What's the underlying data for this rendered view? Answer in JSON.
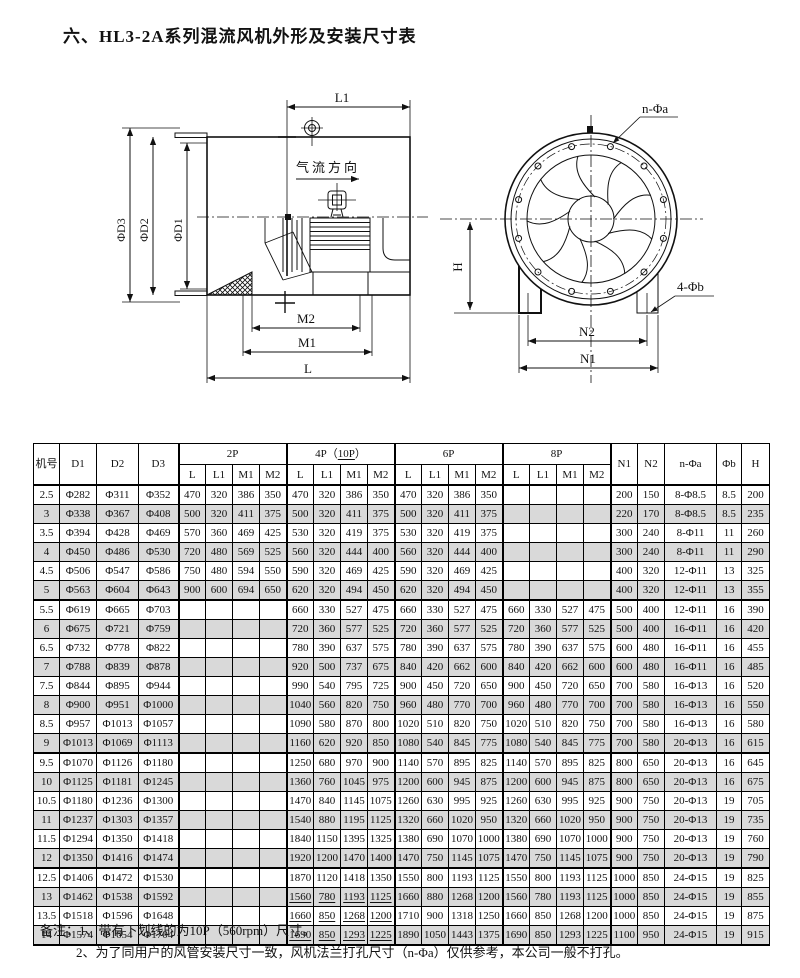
{
  "title": "六、HL3-2A系列混流风机外形及安装尺寸表",
  "diagrams": {
    "left": {
      "l1": "L1",
      "d3": "ΦD3",
      "d2": "ΦD2",
      "d1": "ΦD1",
      "airflow": "气流方向",
      "m2": "M2",
      "m1": "M1",
      "l": "L"
    },
    "right": {
      "n_phi_a": "n-Φa",
      "h": "H",
      "four_phi_b": "4-Φb",
      "n2": "N2",
      "n1": "N1"
    }
  },
  "table": {
    "header": {
      "jihao": "机号",
      "d1": "D1",
      "d2": "D2",
      "d3": "D3",
      "g2": "2P",
      "g4_pre": "4P（",
      "g4_u": "10P",
      "g4_post": "）",
      "g6": "6P",
      "g8": "8P",
      "sub": [
        "L",
        "L1",
        "M1",
        "M2"
      ],
      "n1": "N1",
      "n2": "N2",
      "na": "n-Φa",
      "b": "Φb",
      "h": "H"
    },
    "rows": [
      {
        "no": "2.5",
        "d1": "Φ282",
        "d2": "Φ311",
        "d3": "Φ352",
        "p2": [
          "470",
          "320",
          "386",
          "350"
        ],
        "p4": [
          "470",
          "320",
          "386",
          "350"
        ],
        "p6": [
          "470",
          "320",
          "386",
          "350"
        ],
        "p8": [
          "",
          "",
          "",
          ""
        ],
        "n1": "200",
        "n2": "150",
        "na": "8-Φ8.5",
        "b": "8.5",
        "h": "200",
        "u": false
      },
      {
        "no": "3",
        "d1": "Φ338",
        "d2": "Φ367",
        "d3": "Φ408",
        "p2": [
          "500",
          "320",
          "411",
          "375"
        ],
        "p4": [
          "500",
          "320",
          "411",
          "375"
        ],
        "p6": [
          "500",
          "320",
          "411",
          "375"
        ],
        "p8": [
          "",
          "",
          "",
          ""
        ],
        "n1": "220",
        "n2": "170",
        "na": "8-Φ8.5",
        "b": "8.5",
        "h": "235",
        "u": false
      },
      {
        "no": "3.5",
        "d1": "Φ394",
        "d2": "Φ428",
        "d3": "Φ469",
        "p2": [
          "570",
          "360",
          "469",
          "425"
        ],
        "p4": [
          "530",
          "320",
          "419",
          "375"
        ],
        "p6": [
          "530",
          "320",
          "419",
          "375"
        ],
        "p8": [
          "",
          "",
          "",
          ""
        ],
        "n1": "300",
        "n2": "240",
        "na": "8-Φ11",
        "b": "11",
        "h": "260",
        "u": false
      },
      {
        "no": "4",
        "d1": "Φ450",
        "d2": "Φ486",
        "d3": "Φ530",
        "p2": [
          "720",
          "480",
          "569",
          "525"
        ],
        "p4": [
          "560",
          "320",
          "444",
          "400"
        ],
        "p6": [
          "560",
          "320",
          "444",
          "400"
        ],
        "p8": [
          "",
          "",
          "",
          ""
        ],
        "n1": "300",
        "n2": "240",
        "na": "8-Φ11",
        "b": "11",
        "h": "290",
        "u": false
      },
      {
        "no": "4.5",
        "d1": "Φ506",
        "d2": "Φ547",
        "d3": "Φ586",
        "p2": [
          "750",
          "480",
          "594",
          "550"
        ],
        "p4": [
          "590",
          "320",
          "469",
          "425"
        ],
        "p6": [
          "590",
          "320",
          "469",
          "425"
        ],
        "p8": [
          "",
          "",
          "",
          ""
        ],
        "n1": "400",
        "n2": "320",
        "na": "12-Φ11",
        "b": "13",
        "h": "325",
        "u": false
      },
      {
        "no": "5",
        "d1": "Φ563",
        "d2": "Φ604",
        "d3": "Φ643",
        "p2": [
          "900",
          "600",
          "694",
          "650"
        ],
        "p4": [
          "620",
          "320",
          "494",
          "450"
        ],
        "p6": [
          "620",
          "320",
          "494",
          "450"
        ],
        "p8": [
          "",
          "",
          "",
          ""
        ],
        "n1": "400",
        "n2": "320",
        "na": "12-Φ11",
        "b": "13",
        "h": "355",
        "u": false
      },
      {
        "no": "5.5",
        "d1": "Φ619",
        "d2": "Φ665",
        "d3": "Φ703",
        "p2": [
          "",
          "",
          "",
          ""
        ],
        "p4": [
          "660",
          "330",
          "527",
          "475"
        ],
        "p6": [
          "660",
          "330",
          "527",
          "475"
        ],
        "p8": [
          "660",
          "330",
          "527",
          "475"
        ],
        "n1": "500",
        "n2": "400",
        "na": "12-Φ11",
        "b": "16",
        "h": "390",
        "u": false
      },
      {
        "no": "6",
        "d1": "Φ675",
        "d2": "Φ721",
        "d3": "Φ759",
        "p2": [
          "",
          "",
          "",
          ""
        ],
        "p4": [
          "720",
          "360",
          "577",
          "525"
        ],
        "p6": [
          "720",
          "360",
          "577",
          "525"
        ],
        "p8": [
          "720",
          "360",
          "577",
          "525"
        ],
        "n1": "500",
        "n2": "400",
        "na": "16-Φ11",
        "b": "16",
        "h": "420",
        "u": false
      },
      {
        "no": "6.5",
        "d1": "Φ732",
        "d2": "Φ778",
        "d3": "Φ822",
        "p2": [
          "",
          "",
          "",
          ""
        ],
        "p4": [
          "780",
          "390",
          "637",
          "575"
        ],
        "p6": [
          "780",
          "390",
          "637",
          "575"
        ],
        "p8": [
          "780",
          "390",
          "637",
          "575"
        ],
        "n1": "600",
        "n2": "480",
        "na": "16-Φ11",
        "b": "16",
        "h": "455",
        "u": false
      },
      {
        "no": "7",
        "d1": "Φ788",
        "d2": "Φ839",
        "d3": "Φ878",
        "p2": [
          "",
          "",
          "",
          ""
        ],
        "p4": [
          "920",
          "500",
          "737",
          "675"
        ],
        "p6": [
          "840",
          "420",
          "662",
          "600"
        ],
        "p8": [
          "840",
          "420",
          "662",
          "600"
        ],
        "n1": "600",
        "n2": "480",
        "na": "16-Φ11",
        "b": "16",
        "h": "485",
        "u": false
      },
      {
        "no": "7.5",
        "d1": "Φ844",
        "d2": "Φ895",
        "d3": "Φ944",
        "p2": [
          "",
          "",
          "",
          ""
        ],
        "p4": [
          "990",
          "540",
          "795",
          "725"
        ],
        "p6": [
          "900",
          "450",
          "720",
          "650"
        ],
        "p8": [
          "900",
          "450",
          "720",
          "650"
        ],
        "n1": "700",
        "n2": "580",
        "na": "16-Φ13",
        "b": "16",
        "h": "520",
        "u": false
      },
      {
        "no": "8",
        "d1": "Φ900",
        "d2": "Φ951",
        "d3": "Φ1000",
        "p2": [
          "",
          "",
          "",
          ""
        ],
        "p4": [
          "1040",
          "560",
          "820",
          "750"
        ],
        "p6": [
          "960",
          "480",
          "770",
          "700"
        ],
        "p8": [
          "960",
          "480",
          "770",
          "700"
        ],
        "n1": "700",
        "n2": "580",
        "na": "16-Φ13",
        "b": "16",
        "h": "550",
        "u": false
      },
      {
        "no": "8.5",
        "d1": "Φ957",
        "d2": "Φ1013",
        "d3": "Φ1057",
        "p2": [
          "",
          "",
          "",
          ""
        ],
        "p4": [
          "1090",
          "580",
          "870",
          "800"
        ],
        "p6": [
          "1020",
          "510",
          "820",
          "750"
        ],
        "p8": [
          "1020",
          "510",
          "820",
          "750"
        ],
        "n1": "700",
        "n2": "580",
        "na": "16-Φ13",
        "b": "16",
        "h": "580",
        "u": false
      },
      {
        "no": "9",
        "d1": "Φ1013",
        "d2": "Φ1069",
        "d3": "Φ1113",
        "p2": [
          "",
          "",
          "",
          ""
        ],
        "p4": [
          "1160",
          "620",
          "920",
          "850"
        ],
        "p6": [
          "1080",
          "540",
          "845",
          "775"
        ],
        "p8": [
          "1080",
          "540",
          "845",
          "775"
        ],
        "n1": "700",
        "n2": "580",
        "na": "20-Φ13",
        "b": "16",
        "h": "615",
        "u": false
      },
      {
        "no": "9.5",
        "d1": "Φ1070",
        "d2": "Φ1126",
        "d3": "Φ1180",
        "p2": [
          "",
          "",
          "",
          ""
        ],
        "p4": [
          "1250",
          "680",
          "970",
          "900"
        ],
        "p6": [
          "1140",
          "570",
          "895",
          "825"
        ],
        "p8": [
          "1140",
          "570",
          "895",
          "825"
        ],
        "n1": "800",
        "n2": "650",
        "na": "20-Φ13",
        "b": "16",
        "h": "645",
        "u": false
      },
      {
        "no": "10",
        "d1": "Φ1125",
        "d2": "Φ1181",
        "d3": "Φ1245",
        "p2": [
          "",
          "",
          "",
          ""
        ],
        "p4": [
          "1360",
          "760",
          "1045",
          "975"
        ],
        "p6": [
          "1200",
          "600",
          "945",
          "875"
        ],
        "p8": [
          "1200",
          "600",
          "945",
          "875"
        ],
        "n1": "800",
        "n2": "650",
        "na": "20-Φ13",
        "b": "16",
        "h": "675",
        "u": false
      },
      {
        "no": "10.5",
        "d1": "Φ1180",
        "d2": "Φ1236",
        "d3": "Φ1300",
        "p2": [
          "",
          "",
          "",
          ""
        ],
        "p4": [
          "1470",
          "840",
          "1145",
          "1075"
        ],
        "p6": [
          "1260",
          "630",
          "995",
          "925"
        ],
        "p8": [
          "1260",
          "630",
          "995",
          "925"
        ],
        "n1": "900",
        "n2": "750",
        "na": "20-Φ13",
        "b": "19",
        "h": "705",
        "u": false
      },
      {
        "no": "11",
        "d1": "Φ1237",
        "d2": "Φ1303",
        "d3": "Φ1357",
        "p2": [
          "",
          "",
          "",
          ""
        ],
        "p4": [
          "1540",
          "880",
          "1195",
          "1125"
        ],
        "p6": [
          "1320",
          "660",
          "1020",
          "950"
        ],
        "p8": [
          "1320",
          "660",
          "1020",
          "950"
        ],
        "n1": "900",
        "n2": "750",
        "na": "20-Φ13",
        "b": "19",
        "h": "735",
        "u": false
      },
      {
        "no": "11.5",
        "d1": "Φ1294",
        "d2": "Φ1350",
        "d3": "Φ1418",
        "p2": [
          "",
          "",
          "",
          ""
        ],
        "p4": [
          "1840",
          "1150",
          "1395",
          "1325"
        ],
        "p6": [
          "1380",
          "690",
          "1070",
          "1000"
        ],
        "p8": [
          "1380",
          "690",
          "1070",
          "1000"
        ],
        "n1": "900",
        "n2": "750",
        "na": "20-Φ13",
        "b": "19",
        "h": "760",
        "u": false
      },
      {
        "no": "12",
        "d1": "Φ1350",
        "d2": "Φ1416",
        "d3": "Φ1474",
        "p2": [
          "",
          "",
          "",
          ""
        ],
        "p4": [
          "1920",
          "1200",
          "1470",
          "1400"
        ],
        "p6": [
          "1470",
          "750",
          "1145",
          "1075"
        ],
        "p8": [
          "1470",
          "750",
          "1145",
          "1075"
        ],
        "n1": "900",
        "n2": "750",
        "na": "20-Φ13",
        "b": "19",
        "h": "790",
        "u": false
      },
      {
        "no": "12.5",
        "d1": "Φ1406",
        "d2": "Φ1472",
        "d3": "Φ1530",
        "p2": [
          "",
          "",
          "",
          ""
        ],
        "p4": [
          "1870",
          "1120",
          "1418",
          "1350"
        ],
        "p6": [
          "1550",
          "800",
          "1193",
          "1125"
        ],
        "p8": [
          "1550",
          "800",
          "1193",
          "1125"
        ],
        "n1": "1000",
        "n2": "850",
        "na": "24-Φ15",
        "b": "19",
        "h": "825",
        "u": false
      },
      {
        "no": "13",
        "d1": "Φ1462",
        "d2": "Φ1538",
        "d3": "Φ1592",
        "p2": [
          "",
          "",
          "",
          ""
        ],
        "p4": [
          "1560",
          "780",
          "1193",
          "1125"
        ],
        "p6": [
          "1660",
          "880",
          "1268",
          "1200"
        ],
        "p8": [
          "1560",
          "780",
          "1193",
          "1125"
        ],
        "n1": "1000",
        "n2": "850",
        "na": "24-Φ15",
        "b": "19",
        "h": "855",
        "u": true
      },
      {
        "no": "13.5",
        "d1": "Φ1518",
        "d2": "Φ1596",
        "d3": "Φ1648",
        "p2": [
          "",
          "",
          "",
          ""
        ],
        "p4": [
          "1660",
          "850",
          "1268",
          "1200"
        ],
        "p6": [
          "1710",
          "900",
          "1318",
          "1250"
        ],
        "p8": [
          "1660",
          "850",
          "1268",
          "1200"
        ],
        "n1": "1000",
        "n2": "850",
        "na": "24-Φ15",
        "b": "19",
        "h": "875",
        "u": true
      },
      {
        "no": "14",
        "d1": "Φ1574",
        "d2": "Φ1654",
        "d3": "Φ1704",
        "p2": [
          "",
          "",
          "",
          ""
        ],
        "p4": [
          "1690",
          "850",
          "1293",
          "1225"
        ],
        "p6": [
          "1890",
          "1050",
          "1443",
          "1375"
        ],
        "p8": [
          "1690",
          "850",
          "1293",
          "1225"
        ],
        "n1": "1100",
        "n2": "950",
        "na": "24-Φ15",
        "b": "19",
        "h": "915",
        "u": true
      }
    ]
  },
  "notes": {
    "line1": "备注：1、带有下划线的为10P（560rpm）尺寸。",
    "line2": "2、为了同用户的风管安装尺寸一致，风机法兰打孔尺寸（n-Φa）仅供参考，本公司一般不打孔。"
  }
}
